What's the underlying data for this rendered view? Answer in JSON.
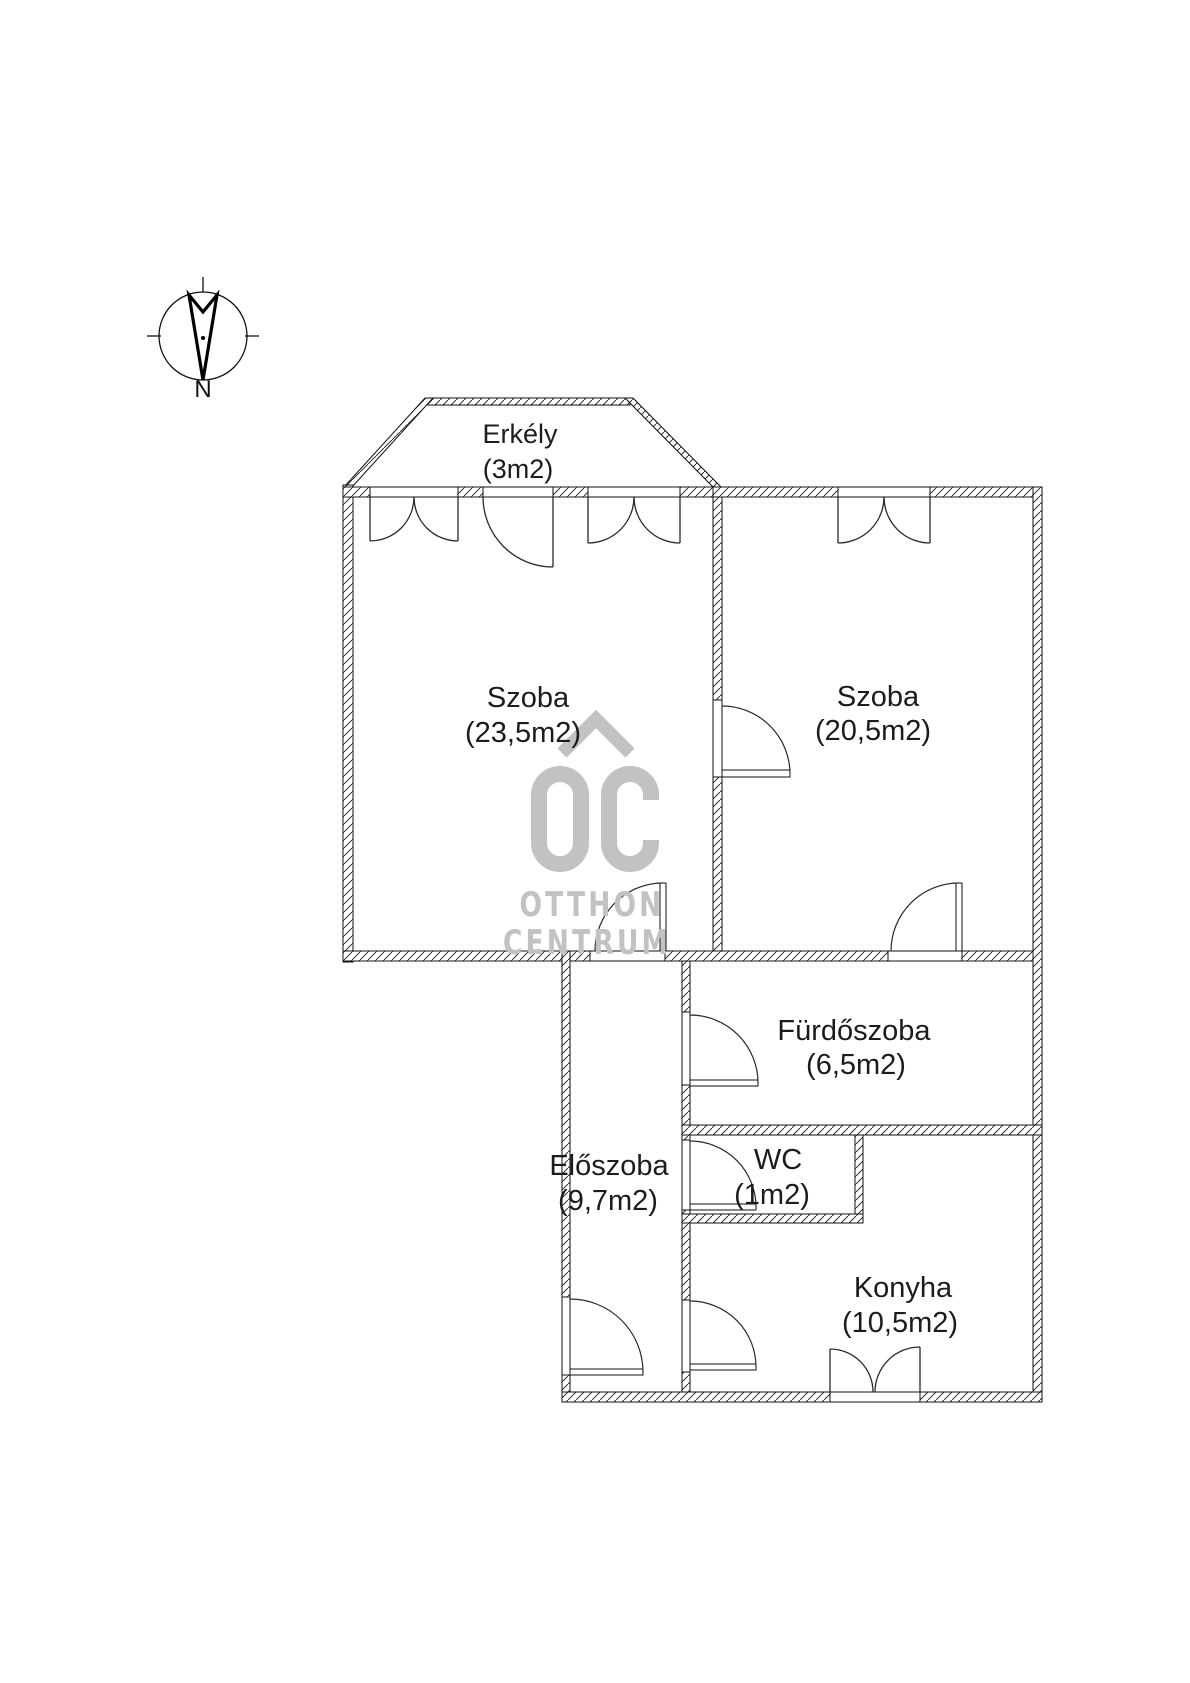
{
  "meta": {
    "background": "#ffffff",
    "line_color": "#1a1a1a",
    "hatch_color": "#3a3a3a",
    "watermark_color": "#c2c2c2"
  },
  "compass": {
    "north_label": "N"
  },
  "watermark": {
    "logo": "OC",
    "line1": "OTTHON",
    "line2": "CENTRUM"
  },
  "rooms": [
    {
      "id": "erkely",
      "name": "Erkély",
      "area": "(3m2)"
    },
    {
      "id": "szoba-1",
      "name": "Szoba",
      "area": "(23,5m2)"
    },
    {
      "id": "szoba-2",
      "name": "Szoba",
      "area": "(20,5m2)"
    },
    {
      "id": "furdoszoba",
      "name": "Fürdőszoba",
      "area": "(6,5m2)"
    },
    {
      "id": "eloszoba",
      "name": "Előszoba",
      "area": "(9,7m2)"
    },
    {
      "id": "wc",
      "name": "WC",
      "area": "(1m2)"
    },
    {
      "id": "konyha",
      "name": "Konyha",
      "area": "(10,5m2)"
    }
  ]
}
